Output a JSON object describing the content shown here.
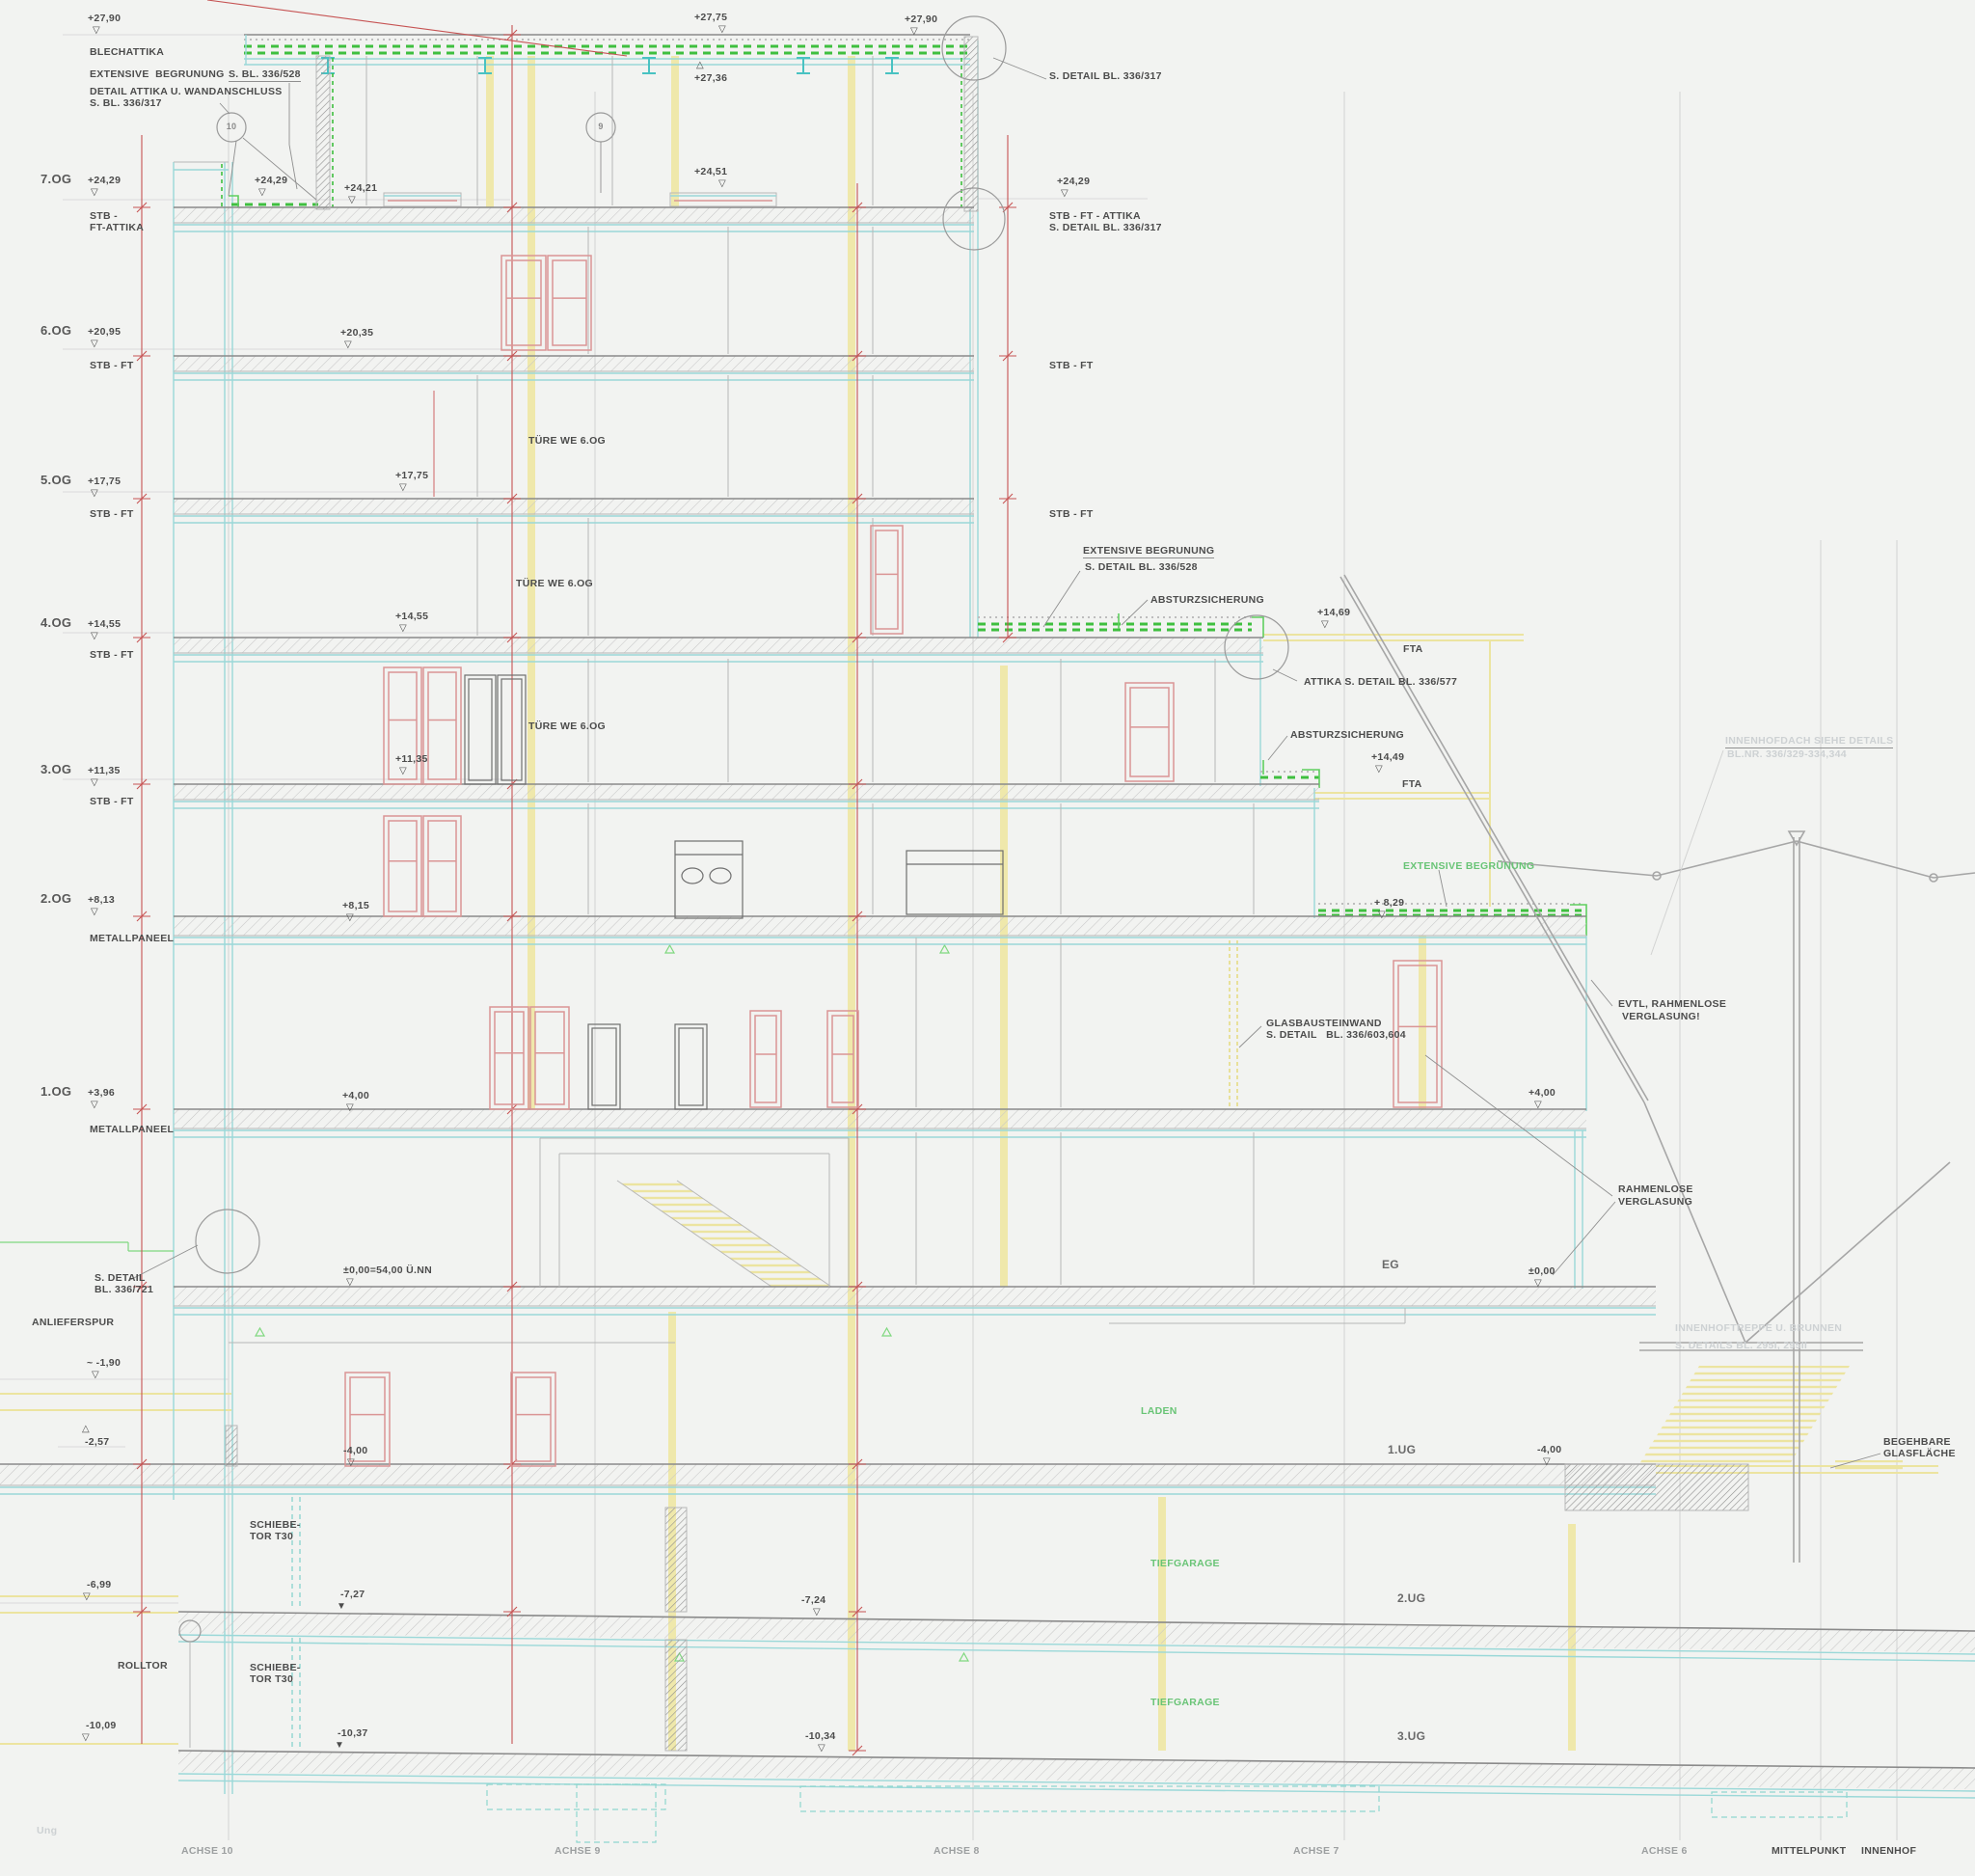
{
  "markers": {
    "d": "▽",
    "u": "△",
    "f": "▼"
  },
  "labels": {
    "top_left_elev": "+27,90",
    "blechattika": "BLECHATTIKA",
    "ext_begr_top": "EXTENSIVE  BEGRUNUNG",
    "detail_attika": "DETAIL ATTIKA U. WANDANSCHLUSS",
    "detail_attika_bl": "S. BL. 336/317",
    "s_bl_336_528": "S. BL. 336/528",
    "circle_10": "10",
    "circle_9": "9",
    "top_mid_elev": "+27,75",
    "top_mid_elev2": "+27,36",
    "elev_24_51": "+24,51",
    "top_right_elev": "+27,90",
    "s_detail_336_317_right": "S. DETAIL BL. 336/317",
    "right_elev_24_29": "+24,29",
    "stb_ft_attika_r1": "STB - FT - ATTIKA",
    "stb_ft_attika_r2": "S. DETAIL BL. 336/317",
    "stb_ft_r6": "STB - FT",
    "stb_ft_r5": "STB - FT",
    "f7": "7.OG",
    "f7_elev": "+24,29",
    "f7_mat1": "STB -",
    "f7_mat2": "FT-ATTIKA",
    "f7_inner": "+24,29",
    "f7_inner2": "+24,21",
    "f6": "6.OG",
    "f6_elev": "+20,95",
    "f6_mat": "STB - FT",
    "f6_inner": "+20,35",
    "f5": "5.OG",
    "f5_elev": "+17,75",
    "f5_mat": "STB - FT",
    "f5_inner": "+17,75",
    "f4": "4.OG",
    "f4_elev": "+14,55",
    "f4_mat": "STB - FT",
    "f4_inner": "+14,55",
    "f3": "3.OG",
    "f3_elev": "+11,35",
    "f3_mat": "STB - FT",
    "f3_inner": "+11,35",
    "f2": "2.OG",
    "f2_elev": "+8,13",
    "f2_mat": "METALLPANEEL",
    "f2_inner": "+8,15",
    "f1": "1.OG",
    "f1_elev": "+3,96",
    "f1_mat": "METALLPANEEL",
    "f1_inner": "+4,00",
    "tuere": "TÜRE WE 6.OG",
    "ext_begr_528_1": "EXTENSIVE BEGRUNUNG",
    "ext_begr_528_2": "S. DETAIL BL. 336/528",
    "absturz": "ABSTURZSICHERUNG",
    "elev_14_69": "+14,69",
    "fta": "FTA",
    "attika_577": "ATTIKA S. DETAIL BL. 336/577",
    "elev_14_49": "+14,49",
    "ext_begruenung_green": "EXTENSIVE BEGRÜNUNG",
    "elev_8_29": "+ 8,29",
    "innenhofdach1": "INNENHOFDACH SIEHE DETAILS",
    "innenhofdach2": "BL.NR. 336/329-334,344",
    "evtl_1": "EVTL, RAHMENLOSE",
    "evtl_2": "VERGLASUNG!",
    "glasbaustein1": "GLASBAUSTEINWAND",
    "glasbaustein2": "S. DETAIL   BL. 336/603,604",
    "rahmenlose1": "RAHMENLOSE",
    "rahmenlose2": "VERGLASUNG",
    "eg": "EG",
    "elev_pm0_full": "±0,00=54,00 Ü.NN",
    "elev_pm0": "±0,00",
    "elev_4_right": "+4,00",
    "s_detail_721_1": "S. DETAIL",
    "s_detail_721_2": "BL. 336/721",
    "anlieferspur": "ANLIEFERSPUR",
    "elev_m190": "~ -1,90",
    "elev_m257": "-2,57",
    "laden": "LADEN",
    "ug1": "1.UG",
    "elev_m4_left": "-4,00",
    "elev_m4_right": "-4,00",
    "innenhoftreppe1": "INNENHOFTREPPE U. BRUNNEN",
    "innenhoftreppe2": "S. DETAILS BL. 295I, 295II",
    "begehbare1": "BEGEHBARE",
    "begehbare2": "GLASFLÄCHE",
    "schiebetor1": "SCHIEBE-",
    "schiebetor2": "TOR T30",
    "elev_m699": "-6,99",
    "elev_m727": "-7,27",
    "elev_m724": "-7,24",
    "ug2": "2.UG",
    "tiefgarage": "TIEFGARAGE",
    "rolltor": "ROLLTOR",
    "elev_m1009": "-10,09",
    "elev_m1037": "-10,37",
    "elev_m1034": "-10,34",
    "ug3": "3.UG",
    "achse10": "ACHSE 10",
    "achse9": "ACHSE 9",
    "achse8": "ACHSE 8",
    "achse7": "ACHSE 7",
    "achse6": "ACHSE 6",
    "mittelpunkt": "MITTELPUNKT",
    "innenhof": "INNENHOF",
    "watermark": "Ung"
  },
  "colors": {
    "greening": "#3fbf3f",
    "structure_cyan": "#9ad8d8",
    "column_yellow": "#efe8ab",
    "dimension_red": "#c65353",
    "door_rose": "#da9595",
    "room_green": "#69c476"
  }
}
